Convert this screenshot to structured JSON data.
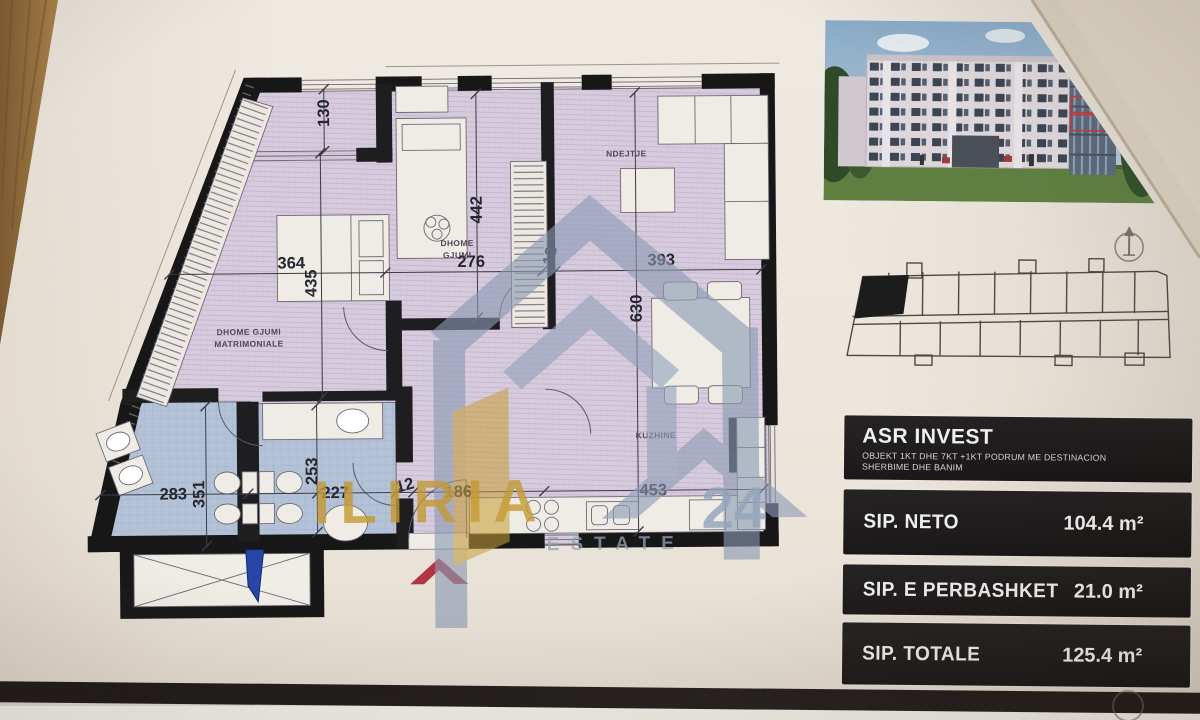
{
  "colors": {
    "brand_gold": "#c49a33",
    "logo_blue_gray": "#8b9ab3",
    "entrance_red": "#b23440",
    "marker_blue": "#2746a8",
    "panel_black": "#211e1f",
    "floor_lilac": "#d7ccdd",
    "bath_blue": "#b3c1d6"
  },
  "watermark": {
    "brand": "ILIRIA",
    "number": "24",
    "sub": "ESTATE"
  },
  "floor_plan": {
    "rooms": {
      "master_line1": "DHOME GJUMI",
      "master_line2": "MATRIMONIALE",
      "bedroom_line1": "DHOME",
      "bedroom_line2": "GJUMI",
      "living": "NDEJTJE",
      "kitchen": "KUZHINE"
    },
    "dims": {
      "loggia": "130",
      "master_w": "364",
      "master_d": "435",
      "bed_w": "276",
      "bed_d": "442",
      "wall_top": "12",
      "living_w": "393",
      "living_d": "630",
      "bath_w": "283",
      "bath_d": "351",
      "wc_d": "253",
      "wc_w": "227",
      "wall_bottom": "12",
      "hall_w": "186",
      "kitchen_w": "453"
    }
  },
  "sidebar": {
    "developer": "ASR INVEST",
    "project_line1": "OBJEKT 1KT DHE 7KT +1KT PODRUM ME DESTINACION",
    "project_line2": "SHERBIME DHE BANIM",
    "areas": [
      {
        "label": "SIP. NETO",
        "value": "104.4 m²"
      },
      {
        "label": "SIP. E PERBASHKET",
        "value": "21.0 m²"
      },
      {
        "label": "SIP. TOTALE",
        "value": "125.4 m²"
      }
    ]
  }
}
